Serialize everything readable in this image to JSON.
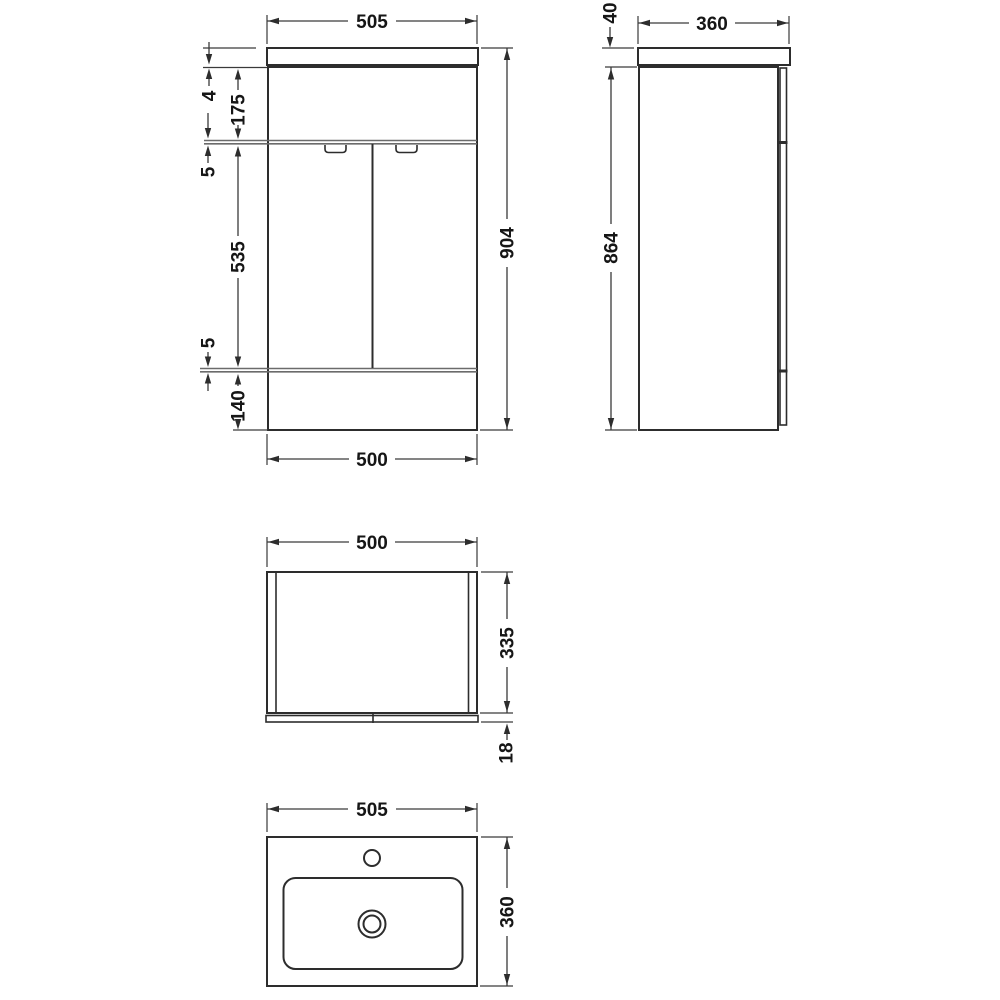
{
  "drawing": {
    "type": "technical-dimension-drawing",
    "subject": "bathroom vanity unit with basin",
    "colors": {
      "background": "#ffffff",
      "object_line": "#2d2d2d",
      "dimension_line": "#3a3a3a",
      "gap_band": "#6b6b6b",
      "text": "#161616"
    },
    "front_view": {
      "width_top": "505",
      "countertop_lip": "4",
      "drawer_height": "175",
      "gap_upper": "5",
      "door_height": "535",
      "gap_lower": "5",
      "plinth_height": "140",
      "overall_height": "904",
      "width_bottom": "500"
    },
    "side_view": {
      "countertop_thickness": "40",
      "depth": "360",
      "carcass_height": "864"
    },
    "plan_view": {
      "width": "500",
      "depth": "335",
      "door_thickness": "18"
    },
    "basin_view": {
      "width": "505",
      "depth": "360"
    }
  }
}
